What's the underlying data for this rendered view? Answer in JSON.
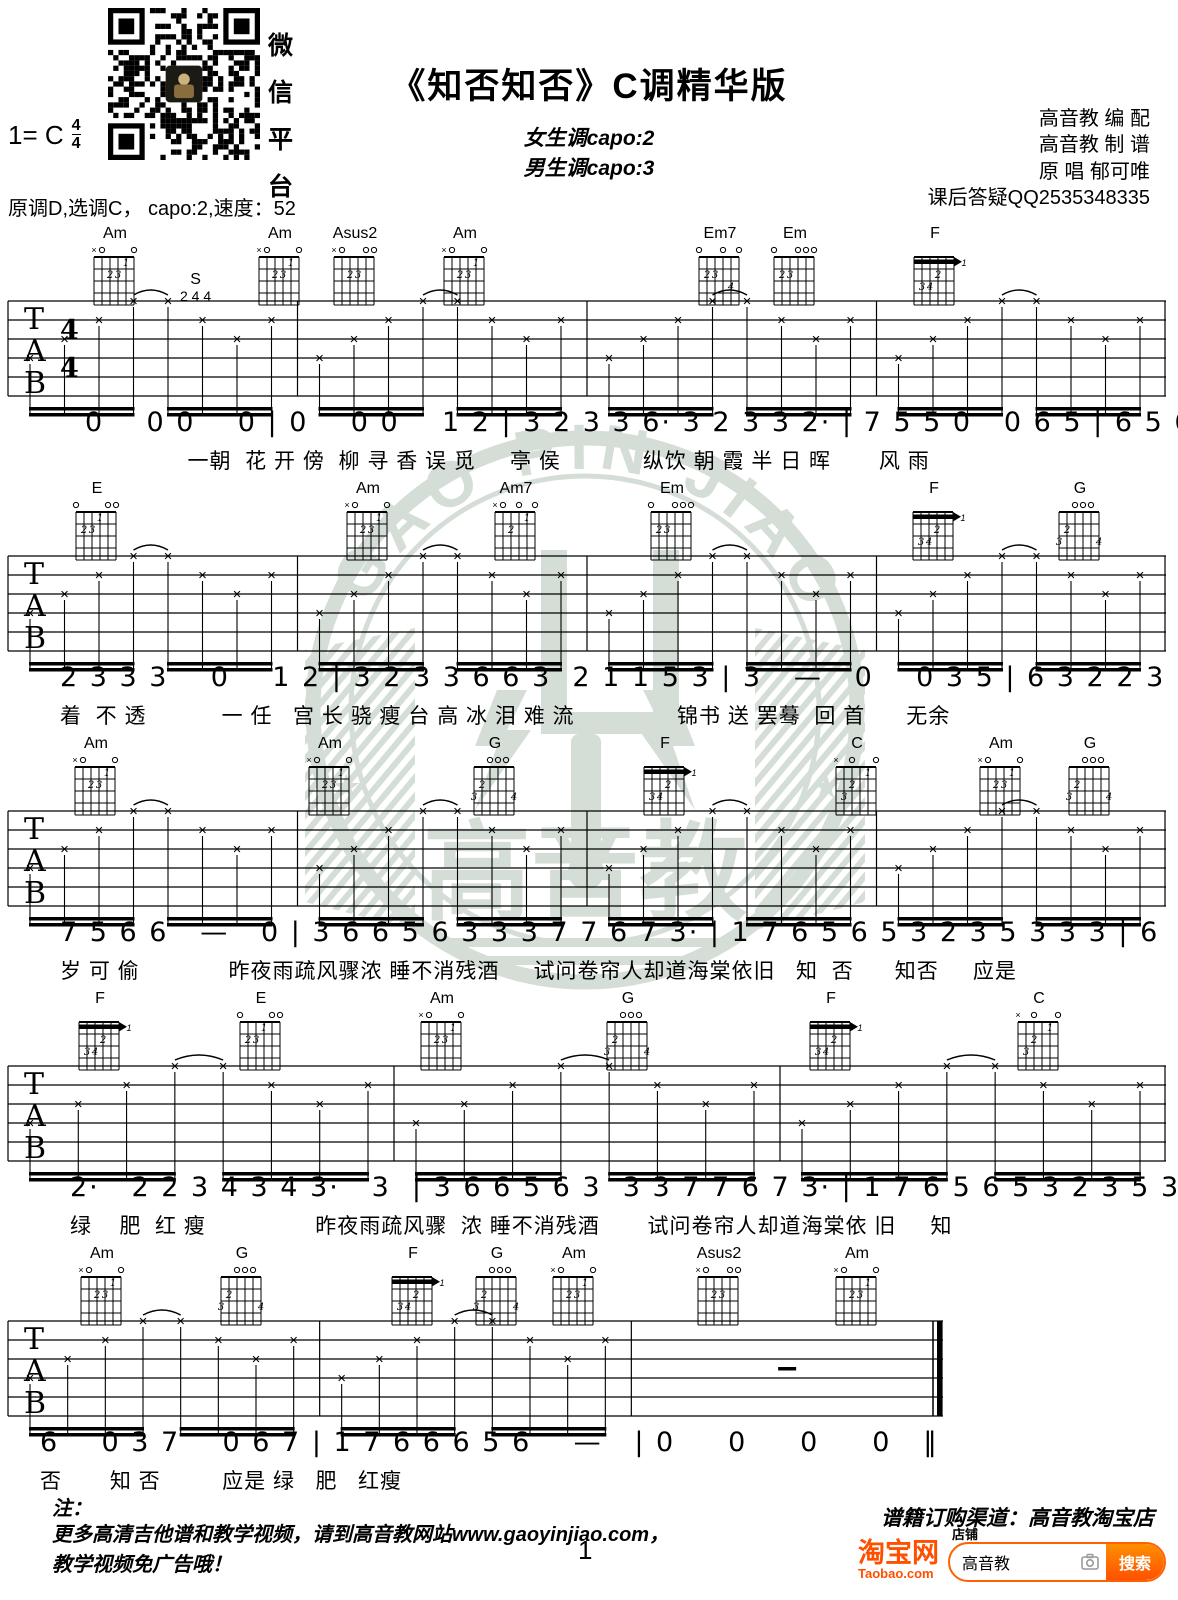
{
  "header": {
    "qr_caption": [
      "微",
      "信",
      "平",
      "台"
    ],
    "key": "1= C",
    "beat_num": "4",
    "beat_den": "4",
    "title": "《知否知否》C调精华版",
    "capo_female": "女生调capo:2",
    "capo_male": "男生调capo:3",
    "tuning": "原调D,选调C， capo:2,速度：52",
    "credits": [
      "高音教 编 配",
      "高音教 制 谱",
      "原 唱 郁可唯",
      "课后答疑QQ2535348335"
    ]
  },
  "watermark": {
    "arc_text": "GAO PIN JIAO",
    "center_text": "高音教",
    "color": "#a9b9ac"
  },
  "chord_shapes": {
    "Am": {
      "top": "xo   o",
      "dots": [
        [
          3,
          2,
          "2"
        ],
        [
          4,
          2,
          "3"
        ],
        [
          5,
          1,
          "1"
        ]
      ]
    },
    "Asus2": {
      "top": "xo  oo",
      "dots": [
        [
          3,
          2,
          "2"
        ],
        [
          4,
          2,
          "3"
        ]
      ]
    },
    "Am7": {
      "top": "xo o o",
      "dots": [
        [
          3,
          2,
          "2"
        ],
        [
          5,
          1,
          "1"
        ]
      ]
    },
    "Em7": {
      "top": "o  o o",
      "dots": [
        [
          2,
          2,
          "2"
        ],
        [
          3,
          2,
          "3"
        ],
        [
          5,
          3,
          "4"
        ]
      ]
    },
    "Em": {
      "top": "o  ooo",
      "dots": [
        [
          2,
          2,
          "2"
        ],
        [
          3,
          2,
          "3"
        ]
      ]
    },
    "E": {
      "top": "o   oo",
      "dots": [
        [
          2,
          2,
          "2"
        ],
        [
          3,
          2,
          "3"
        ],
        [
          4,
          1,
          "1"
        ]
      ]
    },
    "F": {
      "top": "      ",
      "barre": 1,
      "barre_label": "1",
      "dots": [
        [
          4,
          2,
          "2"
        ],
        [
          2,
          3,
          "3"
        ],
        [
          3,
          3,
          "4"
        ]
      ]
    },
    "G": {
      "top": "  ooo ",
      "dots": [
        [
          2,
          2,
          "2"
        ],
        [
          1,
          3,
          "3"
        ],
        [
          6,
          3,
          "4"
        ]
      ]
    },
    "C": {
      "top": "x o  o",
      "dots": [
        [
          2,
          3,
          "3"
        ],
        [
          3,
          2,
          "2"
        ],
        [
          5,
          1,
          "1"
        ]
      ]
    }
  },
  "systems": [
    {
      "top": 225,
      "chords": [
        {
          "name": "Am",
          "x": 115
        },
        {
          "name": "Am",
          "x": 280
        },
        {
          "name": "Asus2",
          "x": 355
        },
        {
          "name": "Am",
          "x": 465
        },
        {
          "name": "Em7",
          "x": 720
        },
        {
          "name": "Em",
          "x": 795
        },
        {
          "name": "F",
          "x": 935
        }
      ],
      "annotation": {
        "text": "S",
        "nums": "2 4 4"
      },
      "measures": 4,
      "show_time_sig": true,
      "staff_w": 1158,
      "indent": 85,
      "notes": "0    0 0    0 | 0    0 0    1 2 | 3 2 3 3 6· 3 2 3 3 2· | 7 5 5 0   0 6 5 | 6 5 6 6 3 3 3   2 1 1",
      "lyrics": "               一朝  花 开 傍  柳 寻 香 误 觅     亭 侯            纵饮 朝 霞 半 日 晖       风 雨"
    },
    {
      "top": 480,
      "chords": [
        {
          "name": "E",
          "x": 97
        },
        {
          "name": "Am",
          "x": 368
        },
        {
          "name": "Am7",
          "x": 516
        },
        {
          "name": "Em",
          "x": 672
        },
        {
          "name": "F",
          "x": 934
        },
        {
          "name": "G",
          "x": 1080
        }
      ],
      "measures": 4,
      "staff_w": 1158,
      "indent": 60,
      "notes": "2 3 3 3    0    1 2 | 3 2 3 3 6 6 3  2 1 1 5 3 | 3   —   0    0 3 5 | 6 3 2 2 3 1 1    2 1",
      "lyrics": "着  不 透           一 任   宫 长 骁 瘦 台 高 冰 泪 难 流               锦书 送 罢蓦  回 首      无余"
    },
    {
      "top": 735,
      "chords": [
        {
          "name": "Am",
          "x": 96
        },
        {
          "name": "Am",
          "x": 330
        },
        {
          "name": "G",
          "x": 495
        },
        {
          "name": "F",
          "x": 665
        },
        {
          "name": "C",
          "x": 857
        },
        {
          "name": "Am",
          "x": 1001
        },
        {
          "name": "G",
          "x": 1090
        }
      ],
      "measures": 4,
      "staff_w": 1158,
      "indent": 60,
      "notes": "7 5 6 6   —   0 | 3 6 6 5 6 3 3 3 7 7 6 7 3· | 1 7 6 5 6 5 3 2 3 5 3 3 3 | 6   0 3 7   0 7 1",
      "lyrics": "岁 可 偷             昨夜雨疏风骤浓 睡不消残酒     试问卷帘人却道海棠依旧   知  否      知否     应是"
    },
    {
      "top": 990,
      "chords": [
        {
          "name": "F",
          "x": 100
        },
        {
          "name": "E",
          "x": 261
        },
        {
          "name": "Am",
          "x": 442
        },
        {
          "name": "G",
          "x": 628
        },
        {
          "name": "F",
          "x": 831
        },
        {
          "name": "C",
          "x": 1039
        }
      ],
      "measures": 3,
      "staff_w": 1158,
      "indent": 70,
      "notes": "2·   2 2 3 4 3 4 3·   3  | 3 6 6 5 6 3  3 3 7 7 6 7 3· | 1 7 6 5 6 5 3 2 3 5 3 3  3",
      "lyrics": "绿    肥  红 瘦                昨夜雨疏风骤  浓 睡不消残酒       试问卷帘人却道海棠依 旧     知"
    },
    {
      "top": 1245,
      "chords": [
        {
          "name": "Am",
          "x": 102
        },
        {
          "name": "G",
          "x": 242
        },
        {
          "name": "F",
          "x": 413
        },
        {
          "name": "G",
          "x": 497
        },
        {
          "name": "Am",
          "x": 574
        },
        {
          "name": "Asus2",
          "x": 719
        },
        {
          "name": "Am",
          "x": 857
        }
      ],
      "measures": 3,
      "staff_w": 935,
      "end": "final",
      "rest_last": true,
      "indent": 40,
      "notes": "6    0 3 7    0 6 7 | 1 7 6 6 6 5 6    —   | 0     0     0     0   ‖",
      "lyrics": "否       知 否         应是 绿   肥   红瘦"
    }
  ],
  "footer": {
    "note_label": "注：",
    "note_line1": "更多高清吉他谱和教学视频，请到高音教网站www.gaoyinjiao.com，",
    "note_line2": "教学视频免广告哦！",
    "page_number": "1",
    "order_text": "谱籍订购渠道：高音教淘宝店",
    "taobao": {
      "logo": "淘宝网",
      "domain": "Taobao.com",
      "tab": "店铺",
      "query": "高音教",
      "search_label": "搜索",
      "orange": "#ff5000"
    }
  }
}
